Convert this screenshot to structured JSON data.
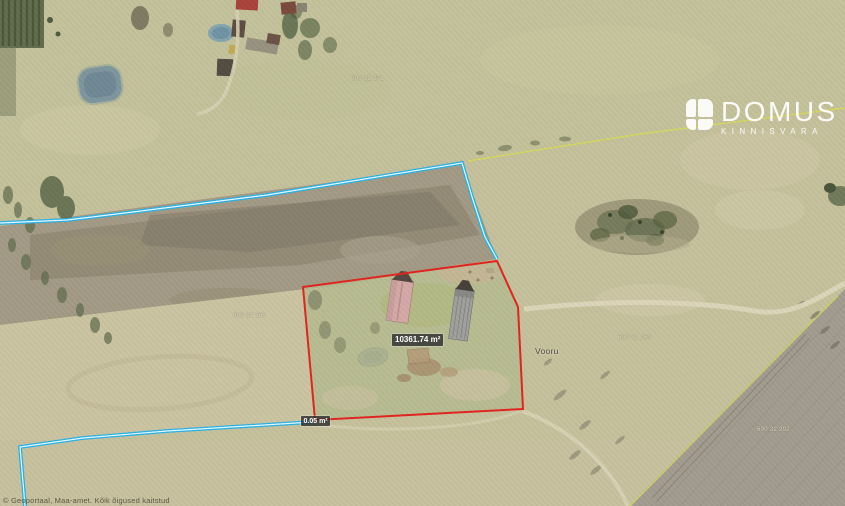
{
  "map": {
    "area_label": "10361.74 m²",
    "segment_label": "0.05 m²",
    "place_name": "Vooru",
    "selected_parcel_area_m2": 10361.74,
    "cadastral_labels": [
      "600 32 971",
      "600 32 260",
      "600 32 160",
      "600 32 292"
    ],
    "attribution": "© Geoportaal, Maa-amet. Kõik õigused kaitstud",
    "colors": {
      "selected_parcel_outline": "#e2231e",
      "cadastral_boundary_cyan": "#28b2e6",
      "boundary_yellow": "#d6d750",
      "measure_label_bg": "#2b2b2b"
    }
  },
  "logo": {
    "name": "DOMUS",
    "subtitle": "KINNISVARA"
  }
}
